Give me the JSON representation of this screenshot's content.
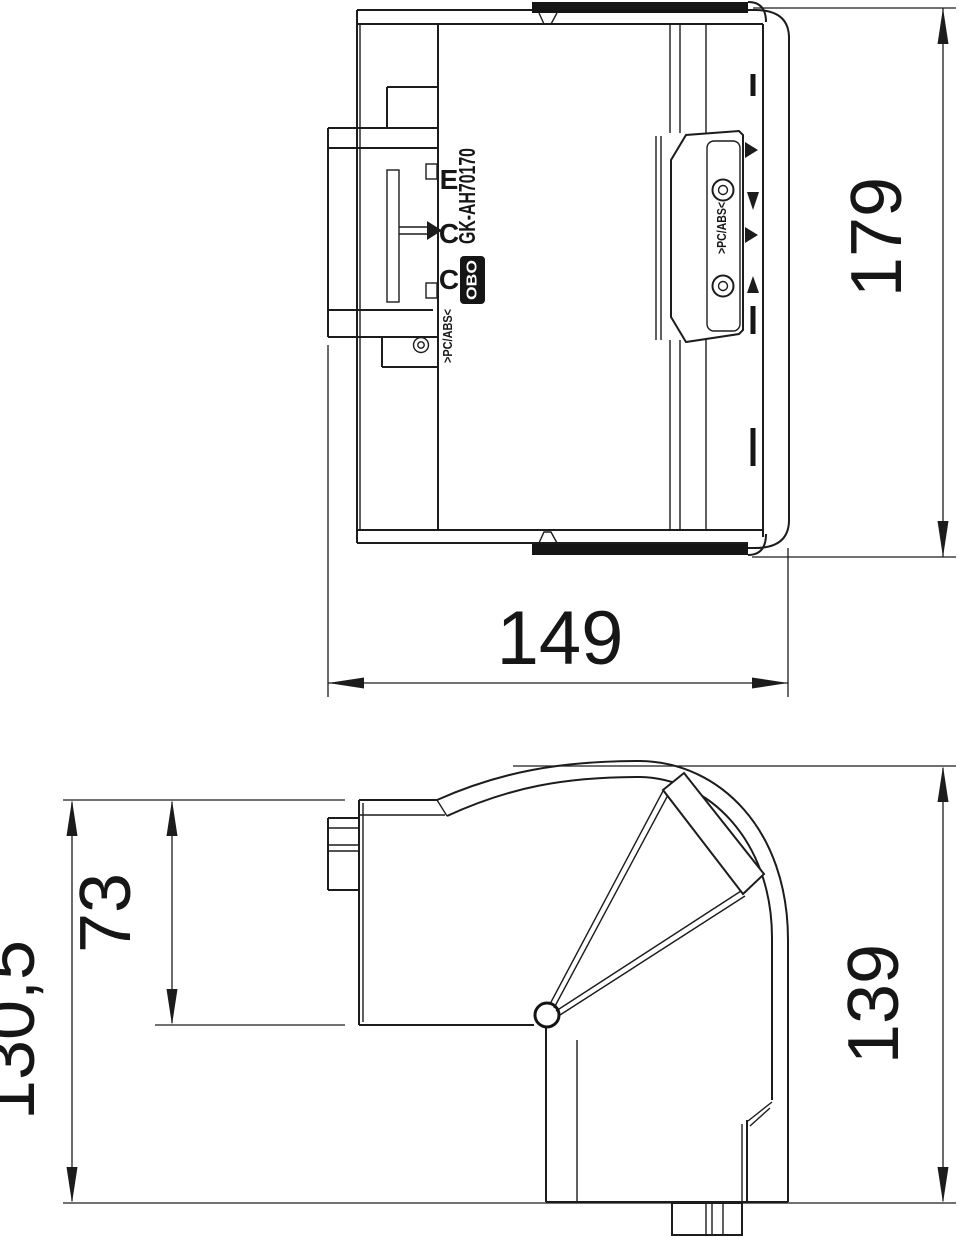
{
  "drawing": {
    "labels": {
      "product_code": "GK-AH70170",
      "brand": "OBO",
      "material_left": ">PC/ABS<",
      "material_right": ">PC/ABS<",
      "mold_marks": [
        "E",
        "C",
        "C"
      ]
    },
    "dimensions": {
      "top_view": {
        "height": "179",
        "width": "149"
      },
      "bottom_view": {
        "overall_height": "130,5",
        "inner_height": "73",
        "right_height": "139"
      }
    },
    "colors": {
      "line": "#1c1c1c",
      "bar": "#151515",
      "background": "#ffffff",
      "text": "#161616"
    }
  }
}
